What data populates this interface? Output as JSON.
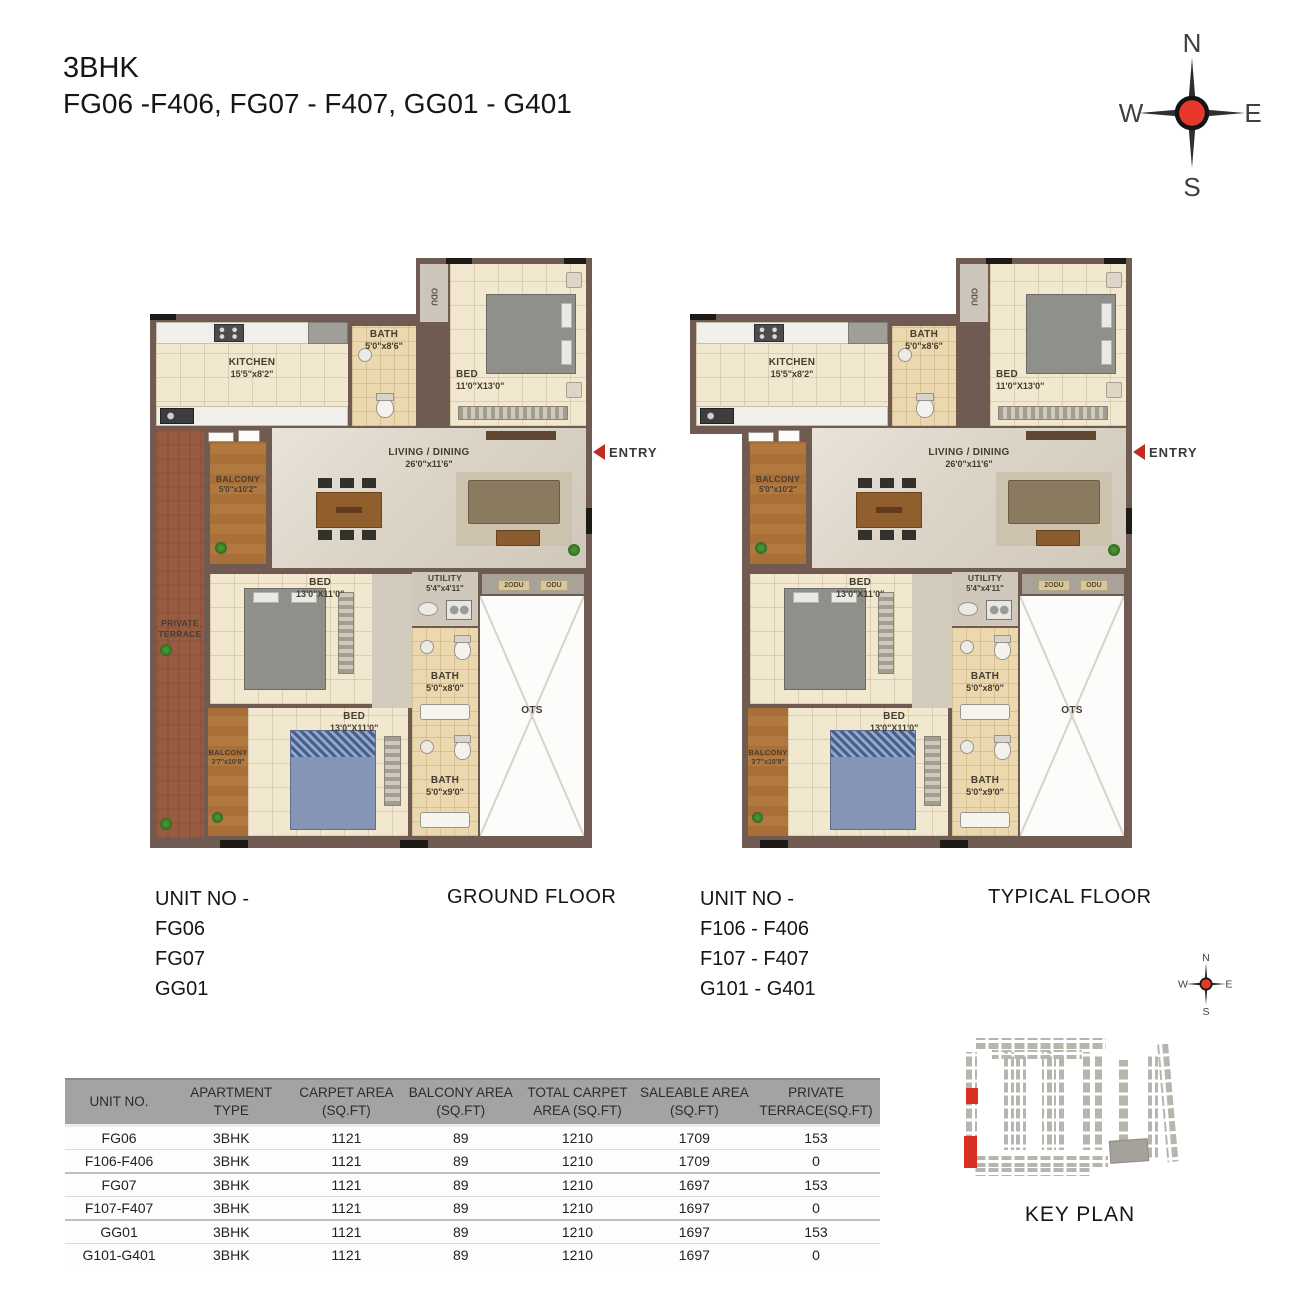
{
  "page": {
    "title_line1": "3BHK",
    "title_line2": "FG06 -F406, FG07 - F407, GG01 - G401"
  },
  "compass": {
    "north": "N",
    "south": "S",
    "east": "E",
    "west": "W"
  },
  "plans": {
    "ground": {
      "unit_heading": "UNIT NO -",
      "unit_lines": [
        "FG06",
        "FG07",
        "GG01"
      ],
      "floor_label": "GROUND FLOOR"
    },
    "typical": {
      "unit_heading": "UNIT NO -",
      "unit_lines": [
        "F106 - F406",
        "F107 - F407",
        "G101 - G401"
      ],
      "floor_label": "TYPICAL FLOOR"
    }
  },
  "rooms": {
    "kitchen": {
      "name": "KITCHEN",
      "size": "15'5\"x8'2\""
    },
    "bath_top": {
      "name": "BATH",
      "size": "5'0\"x8'6\""
    },
    "odu_top": {
      "name": "ODU"
    },
    "bed_master": {
      "name": "BED",
      "size": "11'0\"X13'0\""
    },
    "living": {
      "name": "LIVING / DINING",
      "size": "26'0\"x11'6\""
    },
    "balcony_living": {
      "name": "BALCONY",
      "size": "5'0\"x10'2\""
    },
    "private_terrace": {
      "line1": "PRIVATE",
      "line2": "TERRACE"
    },
    "bed_mid": {
      "name": "BED",
      "size": "13'0\"X11'0\""
    },
    "utility": {
      "name": "UTILITY",
      "size": "5'4\"x4'11\""
    },
    "odu_units": {
      "left": "2ODU",
      "right": "ODU"
    },
    "bath_mid": {
      "name": "BATH",
      "size": "5'0\"x8'0\""
    },
    "bed_bottom": {
      "name": "BED",
      "size": "13'0\"X11'0\""
    },
    "balcony_bottom": {
      "name": "BALCONY",
      "size": "3'7\"x10'8\""
    },
    "bath_bottom": {
      "name": "BATH",
      "size": "5'0\"x9'0\""
    },
    "ots": {
      "name": "OTS"
    },
    "entry": {
      "label": "ENTRY"
    }
  },
  "area_table": {
    "headers": [
      {
        "line1": "UNIT NO.",
        "line2": ""
      },
      {
        "line1": "APARTMENT",
        "line2": "TYPE"
      },
      {
        "line1": "CARPET AREA",
        "line2": "(SQ.FT)"
      },
      {
        "line1": "BALCONY AREA",
        "line2": "(SQ.FT)"
      },
      {
        "line1": "TOTAL CARPET",
        "line2": "AREA (SQ.FT)"
      },
      {
        "line1": "SALEABLE AREA",
        "line2": "(SQ.FT)"
      },
      {
        "line1": "PRIVATE",
        "line2": "TERRACE(SQ.FT)"
      }
    ],
    "rows": [
      [
        "FG06",
        "3BHK",
        "1121",
        "89",
        "1210",
        "1709",
        "153"
      ],
      [
        "F106-F406",
        "3BHK",
        "1121",
        "89",
        "1210",
        "1709",
        "0"
      ],
      [
        "FG07",
        "3BHK",
        "1121",
        "89",
        "1210",
        "1697",
        "153"
      ],
      [
        "F107-F407",
        "3BHK",
        "1121",
        "89",
        "1210",
        "1697",
        "0"
      ],
      [
        "GG01",
        "3BHK",
        "1121",
        "89",
        "1210",
        "1697",
        "153"
      ],
      [
        "G101-G401",
        "3BHK",
        "1121",
        "89",
        "1210",
        "1697",
        "0"
      ]
    ]
  },
  "key_plan": {
    "label": "KEY PLAN"
  },
  "colors": {
    "accent_red": "#d02a20",
    "wall": "#6f5b51",
    "balcony_wood": "#ad763e",
    "terrace_brick": "#98593d",
    "table_header_gray": "#a3a3a3"
  }
}
